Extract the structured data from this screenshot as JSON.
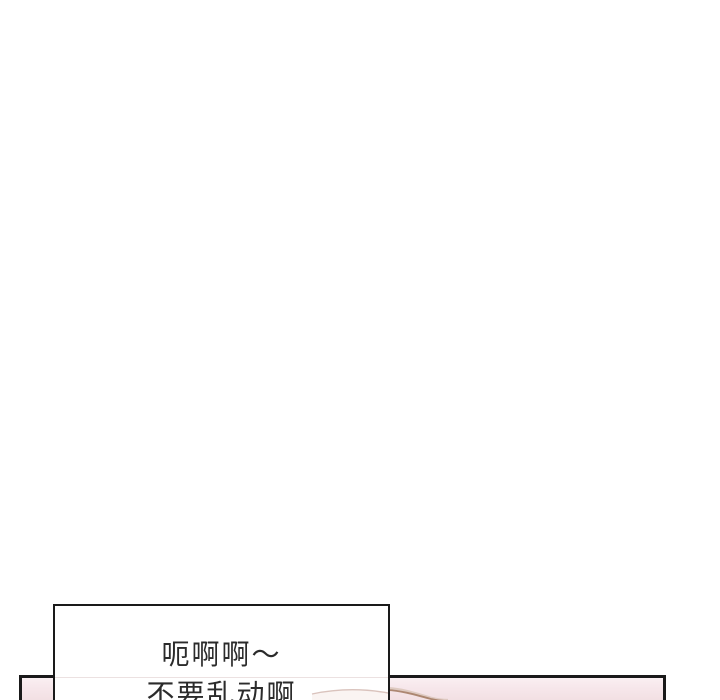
{
  "comic_page": {
    "background_color": "#ffffff",
    "speech_bubble": {
      "lines": [
        "呃啊啊～",
        "不要乱动啊"
      ],
      "border_color": "#1a1a1a",
      "fill_color": "#ffffff",
      "text_color": "#2b2b2b"
    },
    "bottom_panel": {
      "border_color": "#1a1a1a",
      "fill_color": "#f2dfe2",
      "fill_top_color": "#faf0f2",
      "skin_outline_color": "#a0775d",
      "highlight_outline_color": "#d9c3bc"
    }
  }
}
